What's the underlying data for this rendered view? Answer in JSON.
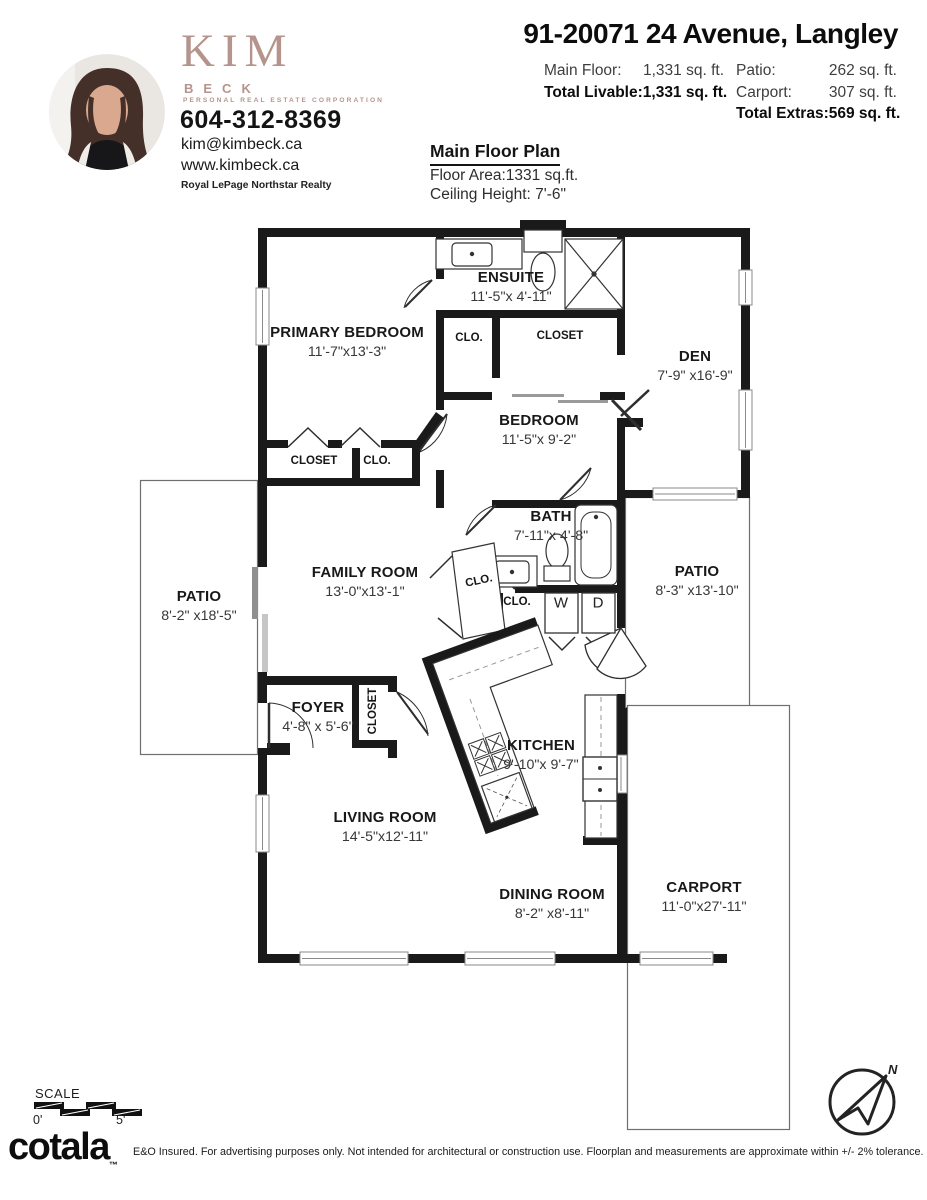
{
  "agent": {
    "brand_first": "KIM",
    "brand_last": "BECK",
    "brand_tagline": "PERSONAL  REAL  ESTATE  CORPORATION",
    "phone": "604-312-8369",
    "email": "kim@kimbeck.ca",
    "website": "www.kimbeck.ca",
    "brokerage": "Royal LePage Northstar Realty",
    "brand_color": "#b5948c"
  },
  "header": {
    "address": "91-20071 24 Avenue, Langley",
    "stats_left": [
      {
        "label": "Main Floor:",
        "value": "1,331 sq. ft.",
        "bold": false
      },
      {
        "label": "Total Livable:",
        "value": "1,331 sq. ft.",
        "bold": true
      }
    ],
    "stats_right": [
      {
        "label": "Patio:",
        "value": "262 sq. ft.",
        "bold": false
      },
      {
        "label": "Carport:",
        "value": "307 sq. ft.",
        "bold": false
      },
      {
        "label": "Total Extras:",
        "value": "569 sq. ft.",
        "bold": true
      }
    ]
  },
  "plan_header": {
    "title": "Main Floor Plan",
    "floor_area": "Floor Area:1331 sq.ft.",
    "ceiling": "Ceiling Height: 7'-6\""
  },
  "rooms": {
    "primary_bedroom": {
      "name": "PRIMARY BEDROOM",
      "dims": "11'-7\"x13'-3\""
    },
    "ensuite": {
      "name": "ENSUITE",
      "dims": "11'-5\"x 4'-11\""
    },
    "den": {
      "name": "DEN",
      "dims": "7'-9\" x16'-9\""
    },
    "bedroom": {
      "name": "BEDROOM",
      "dims": "11'-5\"x 9'-2\""
    },
    "bath": {
      "name": "BATH",
      "dims": "7'-11\"x 4'-8\""
    },
    "patio_left": {
      "name": "PATIO",
      "dims": "8'-2\" x18'-5\""
    },
    "family_room": {
      "name": "FAMILY ROOM",
      "dims": "13'-0\"x13'-1\""
    },
    "patio_right": {
      "name": "PATIO",
      "dims": "8'-3\" x13'-10\""
    },
    "foyer": {
      "name": "FOYER",
      "dims": "4'-8\" x 5'-6\""
    },
    "kitchen": {
      "name": "KITCHEN",
      "dims": "9'-10\"x 9'-7\""
    },
    "living_room": {
      "name": "LIVING ROOM",
      "dims": "14'-5\"x12'-11\""
    },
    "dining_room": {
      "name": "DINING ROOM",
      "dims": "8'-2\" x8'-11\""
    },
    "carport": {
      "name": "CARPORT",
      "dims": "11'-0\"x27'-11\""
    }
  },
  "labels": {
    "clo_hall": "CLO.",
    "closet_hall": "CLOSET",
    "closet_primary": "CLOSET",
    "clo_primary": "CLO.",
    "clo_family": "CLO.",
    "clo_laundry": "CLO.",
    "washer": "W",
    "dryer": "D",
    "closet_foyer": "CLOSET"
  },
  "footer": {
    "scale_label": "SCALE",
    "scale_start": "0'",
    "scale_end": "5'",
    "logo": "cotala",
    "logo_tm": "™",
    "compass_n": "N",
    "disclaimer": "E&O Insured. For advertising purposes only. Not intended for architectural or construction use. Floorplan and measurements are approximate within +/- 2% tolerance."
  }
}
